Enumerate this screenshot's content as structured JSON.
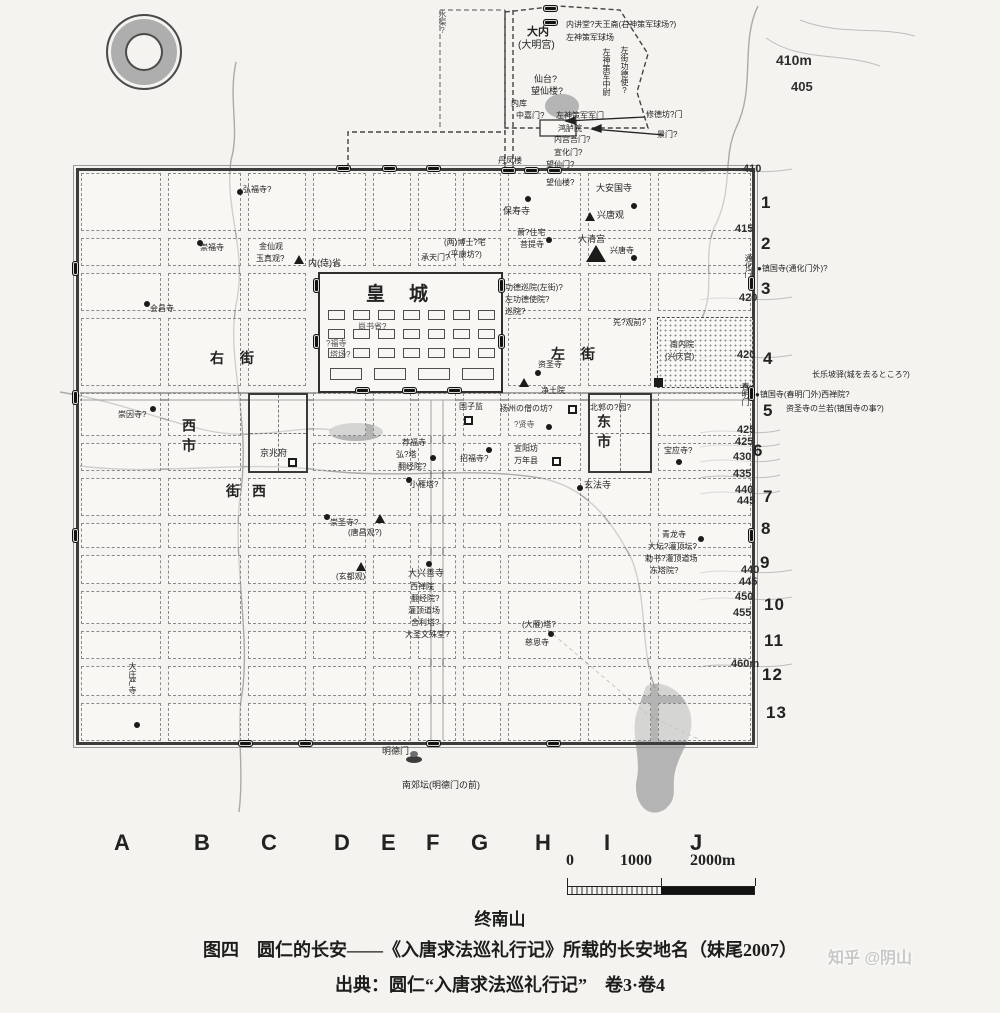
{
  "figure": {
    "mountain_label": "终南山",
    "caption_line1": "图四　圆仁的长安——《入唐求法巡礼行记》所载的长安地名（妹尾2007）",
    "caption_line2": "出典：圆仁“入唐求法巡礼行记”　卷3·卷4",
    "watermark": "知乎 @阴山"
  },
  "scalebar": {
    "t0": "0",
    "t1": "1000",
    "t2": "2000m"
  },
  "grid_letters": [
    {
      "t": "A",
      "x": 114
    },
    {
      "t": "B",
      "x": 194
    },
    {
      "t": "C",
      "x": 261
    },
    {
      "t": "D",
      "x": 334
    },
    {
      "t": "E",
      "x": 381
    },
    {
      "t": "F",
      "x": 426
    },
    {
      "t": "G",
      "x": 471
    },
    {
      "t": "H",
      "x": 535
    },
    {
      "t": "I",
      "x": 604
    },
    {
      "t": "J",
      "x": 690
    }
  ],
  "row_numbers": [
    {
      "t": "1",
      "x": 761,
      "y": 193
    },
    {
      "t": "2",
      "x": 761,
      "y": 234
    },
    {
      "t": "3",
      "x": 761,
      "y": 279
    },
    {
      "t": "4",
      "x": 763,
      "y": 349
    },
    {
      "t": "5",
      "x": 763,
      "y": 401
    },
    {
      "t": "6",
      "x": 753,
      "y": 441
    },
    {
      "t": "7",
      "x": 763,
      "y": 487
    },
    {
      "t": "8",
      "x": 761,
      "y": 519
    },
    {
      "t": "9",
      "x": 760,
      "y": 553
    },
    {
      "t": "10",
      "x": 764,
      "y": 595
    },
    {
      "t": "11",
      "x": 764,
      "y": 631
    },
    {
      "t": "12",
      "x": 762,
      "y": 665
    },
    {
      "t": "13",
      "x": 766,
      "y": 703
    }
  ],
  "elevations": [
    {
      "t": "410m",
      "x": 776,
      "y": 52,
      "fs": 14
    },
    {
      "t": "405",
      "x": 791,
      "y": 79,
      "fs": 13
    },
    {
      "t": "410",
      "x": 743,
      "y": 163
    },
    {
      "t": "415",
      "x": 735,
      "y": 223
    },
    {
      "t": "420",
      "x": 739,
      "y": 292
    },
    {
      "t": "420",
      "x": 737,
      "y": 349
    },
    {
      "t": "425",
      "x": 737,
      "y": 424
    },
    {
      "t": "425",
      "x": 735,
      "y": 436
    },
    {
      "t": "430",
      "x": 733,
      "y": 451
    },
    {
      "t": "435",
      "x": 733,
      "y": 468
    },
    {
      "t": "440",
      "x": 735,
      "y": 484
    },
    {
      "t": "445",
      "x": 737,
      "y": 495
    },
    {
      "t": "440",
      "x": 741,
      "y": 564
    },
    {
      "t": "445",
      "x": 739,
      "y": 576
    },
    {
      "t": "450",
      "x": 735,
      "y": 591
    },
    {
      "t": "455",
      "x": 733,
      "y": 607
    },
    {
      "t": "460m",
      "x": 731,
      "y": 658
    }
  ],
  "labels": [
    {
      "t": "大内",
      "x": 527,
      "y": 26,
      "fs": 11,
      "b": 1
    },
    {
      "t": "(大明宫)",
      "x": 518,
      "y": 40,
      "fs": 10
    },
    {
      "t": "内讲堂?天王斋(右神策军球场?)",
      "x": 566,
      "y": 20,
      "fs": 8
    },
    {
      "t": "左神策军球场",
      "x": 566,
      "y": 33,
      "fs": 8
    },
    {
      "t": "仙台?",
      "x": 534,
      "y": 74,
      "fs": 9
    },
    {
      "t": "望仙楼?",
      "x": 531,
      "y": 86,
      "fs": 9
    },
    {
      "t": "左神策军中尉",
      "x": 602,
      "y": 48,
      "fs": 8,
      "v": 1
    },
    {
      "t": "左街功德使?",
      "x": 620,
      "y": 46,
      "fs": 8,
      "v": 1
    },
    {
      "t": "水渠?",
      "x": 438,
      "y": 10,
      "fs": 8,
      "v": 1,
      "c": "#555"
    },
    {
      "t": "内库",
      "x": 511,
      "y": 99,
      "fs": 8
    },
    {
      "t": "中嘉门?",
      "x": 516,
      "y": 111,
      "fs": 8
    },
    {
      "t": "左神策军军门",
      "x": 556,
      "y": 111,
      "fs": 8
    },
    {
      "t": "鸿胪院",
      "x": 558,
      "y": 124,
      "fs": 8
    },
    {
      "t": "内宫吾门?",
      "x": 554,
      "y": 135,
      "fs": 8
    },
    {
      "t": "宣化门?",
      "x": 554,
      "y": 148,
      "fs": 8
    },
    {
      "t": "丹凤楼",
      "x": 498,
      "y": 156,
      "fs": 8
    },
    {
      "t": "望仙门?",
      "x": 546,
      "y": 160,
      "fs": 8
    },
    {
      "t": "修德坊?门",
      "x": 646,
      "y": 110,
      "fs": 8
    },
    {
      "t": "景门?",
      "x": 657,
      "y": 130,
      "fs": 8
    },
    {
      "t": "弘福寺?",
      "x": 243,
      "y": 185,
      "fs": 8
    },
    {
      "t": "望仙楼?",
      "x": 546,
      "y": 178,
      "fs": 8
    },
    {
      "t": "大安国寺",
      "x": 596,
      "y": 183,
      "fs": 9
    },
    {
      "t": "保寿寺",
      "x": 503,
      "y": 206,
      "fs": 9
    },
    {
      "t": "兴唐观",
      "x": 597,
      "y": 210,
      "fs": 9
    },
    {
      "t": "崇福寺",
      "x": 200,
      "y": 243,
      "fs": 8
    },
    {
      "t": "金仙观",
      "x": 259,
      "y": 242,
      "fs": 8
    },
    {
      "t": "玉真观?",
      "x": 256,
      "y": 254,
      "fs": 8
    },
    {
      "t": "(两)博士?宅",
      "x": 444,
      "y": 238,
      "fs": 8
    },
    {
      "t": "(平康坊?)",
      "x": 448,
      "y": 250,
      "fs": 8
    },
    {
      "t": "萧?住宅",
      "x": 517,
      "y": 228,
      "fs": 8
    },
    {
      "t": "菩提寺",
      "x": 520,
      "y": 240,
      "fs": 8
    },
    {
      "t": "大清宫",
      "x": 578,
      "y": 234,
      "fs": 9
    },
    {
      "t": "兴唐寺",
      "x": 610,
      "y": 246,
      "fs": 8
    },
    {
      "t": "内(侍)省",
      "x": 308,
      "y": 258,
      "fs": 9
    },
    {
      "t": "承天门?",
      "x": 421,
      "y": 253,
      "fs": 8
    },
    {
      "t": "会昌寺",
      "x": 150,
      "y": 304,
      "fs": 8
    },
    {
      "t": "皇城",
      "x": 366,
      "y": 284,
      "fs": 19,
      "b": 1,
      "sp": 24
    },
    {
      "t": "功德巡院(左街)?",
      "x": 505,
      "y": 283,
      "fs": 8
    },
    {
      "t": "左功德使院?",
      "x": 505,
      "y": 295,
      "fs": 8
    },
    {
      "t": "巡院?",
      "x": 505,
      "y": 307,
      "fs": 8
    },
    {
      "t": "先?观前?",
      "x": 613,
      "y": 318,
      "fs": 8
    },
    {
      "t": "尚书省?",
      "x": 358,
      "y": 322,
      "fs": 8,
      "c": "#444"
    },
    {
      "t": "?福寺",
      "x": 326,
      "y": 339,
      "fs": 8,
      "c": "#555"
    },
    {
      "t": "塔场?",
      "x": 330,
      "y": 350,
      "fs": 8,
      "c": "#555"
    },
    {
      "t": "右街",
      "x": 210,
      "y": 350,
      "fs": 14,
      "b": 1,
      "sp": 16
    },
    {
      "t": "左街",
      "x": 551,
      "y": 346,
      "fs": 14,
      "b": 1,
      "sp": 16
    },
    {
      "t": "资圣寺",
      "x": 538,
      "y": 360,
      "fs": 8
    },
    {
      "t": "净土院",
      "x": 541,
      "y": 386,
      "fs": 8
    },
    {
      "t": "南内院",
      "x": 670,
      "y": 340,
      "fs": 8
    },
    {
      "t": "(兴庆宫)",
      "x": 665,
      "y": 352,
      "fs": 8
    },
    {
      "t": "通化门",
      "x": 744,
      "y": 254,
      "fs": 8,
      "v": 1
    },
    {
      "t": "●镇国寺(通化门外)?",
      "x": 757,
      "y": 264,
      "fs": 8
    },
    {
      "t": "春明门",
      "x": 741,
      "y": 382,
      "fs": 8,
      "v": 1
    },
    {
      "t": "长乐坡驿(城を去るところ?)",
      "x": 812,
      "y": 370,
      "fs": 8
    },
    {
      "t": "●镇国寺(春明门外)西禅院?",
      "x": 755,
      "y": 390,
      "fs": 8
    },
    {
      "t": "资圣寺の兰若(镇国寺の事?)",
      "x": 786,
      "y": 404,
      "fs": 8
    },
    {
      "t": "崇因寺?",
      "x": 118,
      "y": 410,
      "fs": 8
    },
    {
      "t": "国子监",
      "x": 459,
      "y": 402,
      "fs": 8
    },
    {
      "t": "扬州の僧の坊?",
      "x": 500,
      "y": 404,
      "fs": 8
    },
    {
      "t": "北郭の?园?",
      "x": 590,
      "y": 403,
      "fs": 8
    },
    {
      "t": "?贤寺",
      "x": 514,
      "y": 420,
      "fs": 8,
      "c": "#555"
    },
    {
      "t": "西市",
      "x": 182,
      "y": 418,
      "fs": 14,
      "b": 1,
      "v": 1,
      "sp": 6
    },
    {
      "t": "东市",
      "x": 597,
      "y": 414,
      "fs": 14,
      "b": 1,
      "v": 1,
      "sp": 6
    },
    {
      "t": "京兆府",
      "x": 260,
      "y": 448,
      "fs": 9
    },
    {
      "t": "宝应寺?",
      "x": 664,
      "y": 446,
      "fs": 8
    },
    {
      "t": "招福寺?",
      "x": 460,
      "y": 454,
      "fs": 8
    },
    {
      "t": "宣阳坊",
      "x": 514,
      "y": 444,
      "fs": 8
    },
    {
      "t": "万年县",
      "x": 514,
      "y": 456,
      "fs": 8
    },
    {
      "t": "荐福寺",
      "x": 402,
      "y": 438,
      "fs": 8
    },
    {
      "t": "弘?塔",
      "x": 396,
      "y": 450,
      "fs": 8
    },
    {
      "t": "翻经院?",
      "x": 398,
      "y": 462,
      "fs": 8
    },
    {
      "t": "小雁塔?",
      "x": 410,
      "y": 480,
      "fs": 8
    },
    {
      "t": "街西",
      "x": 226,
      "y": 483,
      "fs": 14,
      "b": 1,
      "sp": 12
    },
    {
      "t": "玄法寺",
      "x": 584,
      "y": 480,
      "fs": 9
    },
    {
      "t": "崇圣寺?",
      "x": 330,
      "y": 518,
      "fs": 8
    },
    {
      "t": "(唐昌观?)",
      "x": 348,
      "y": 528,
      "fs": 8
    },
    {
      "t": "青龙寺",
      "x": 662,
      "y": 530,
      "fs": 8
    },
    {
      "t": "大坛?灌顶坛?",
      "x": 648,
      "y": 542,
      "fs": 8
    },
    {
      "t": "勅书?灌顶道场",
      "x": 645,
      "y": 554,
      "fs": 8
    },
    {
      "t": "东塔院?",
      "x": 650,
      "y": 566,
      "fs": 8
    },
    {
      "t": "(玄都观)",
      "x": 336,
      "y": 572,
      "fs": 8
    },
    {
      "t": "大兴善寺",
      "x": 408,
      "y": 568,
      "fs": 9
    },
    {
      "t": "西禅院",
      "x": 410,
      "y": 582,
      "fs": 8
    },
    {
      "t": "翻经院?",
      "x": 411,
      "y": 594,
      "fs": 8
    },
    {
      "t": "灌顶道场",
      "x": 408,
      "y": 606,
      "fs": 8
    },
    {
      "t": "舍利塔?",
      "x": 411,
      "y": 618,
      "fs": 8
    },
    {
      "t": "大圣文殊堂?",
      "x": 405,
      "y": 630,
      "fs": 8
    },
    {
      "t": "(大雁)塔?",
      "x": 522,
      "y": 620,
      "fs": 8
    },
    {
      "t": "慈恩寺",
      "x": 525,
      "y": 638,
      "fs": 8
    },
    {
      "t": "大庄严寺",
      "x": 128,
      "y": 662,
      "fs": 8,
      "v": 1
    },
    {
      "t": "明德门",
      "x": 382,
      "y": 746,
      "fs": 9
    },
    {
      "t": "南郊坛(明德门の前)",
      "x": 402,
      "y": 780,
      "fs": 9
    }
  ],
  "markers": [
    {
      "k": "c",
      "x": 237,
      "y": 189
    },
    {
      "k": "c",
      "x": 525,
      "y": 196
    },
    {
      "k": "c",
      "x": 631,
      "y": 203
    },
    {
      "k": "c",
      "x": 197,
      "y": 240
    },
    {
      "k": "c",
      "x": 144,
      "y": 301
    },
    {
      "k": "c",
      "x": 546,
      "y": 237
    },
    {
      "k": "c",
      "x": 631,
      "y": 255
    },
    {
      "k": "c",
      "x": 535,
      "y": 370
    },
    {
      "k": "c",
      "x": 150,
      "y": 406
    },
    {
      "k": "c",
      "x": 486,
      "y": 447
    },
    {
      "k": "c",
      "x": 546,
      "y": 424
    },
    {
      "k": "c",
      "x": 577,
      "y": 485
    },
    {
      "k": "c",
      "x": 430,
      "y": 455
    },
    {
      "k": "c",
      "x": 406,
      "y": 477
    },
    {
      "k": "c",
      "x": 324,
      "y": 514
    },
    {
      "k": "c",
      "x": 426,
      "y": 561
    },
    {
      "k": "c",
      "x": 548,
      "y": 631
    },
    {
      "k": "c",
      "x": 698,
      "y": 536
    },
    {
      "k": "c",
      "x": 676,
      "y": 459
    },
    {
      "k": "c",
      "x": 134,
      "y": 722
    },
    {
      "k": "t",
      "x": 294,
      "y": 255
    },
    {
      "k": "t",
      "x": 585,
      "y": 212
    },
    {
      "k": "t",
      "x": 519,
      "y": 378
    },
    {
      "k": "t",
      "x": 375,
      "y": 514
    },
    {
      "k": "t",
      "x": 356,
      "y": 562
    },
    {
      "k": "T",
      "x": 586,
      "y": 245
    },
    {
      "k": "s",
      "x": 654,
      "y": 378
    },
    {
      "k": "o",
      "x": 464,
      "y": 416
    },
    {
      "k": "o",
      "x": 288,
      "y": 458
    },
    {
      "k": "o",
      "x": 552,
      "y": 457
    },
    {
      "k": "o",
      "x": 568,
      "y": 405
    },
    {
      "k": "altar",
      "x": 406,
      "y": 756
    },
    {
      "k": "gh",
      "x": 336,
      "y": 165
    },
    {
      "k": "gh",
      "x": 382,
      "y": 165
    },
    {
      "k": "gh",
      "x": 426,
      "y": 165
    },
    {
      "k": "gh",
      "x": 501,
      "y": 167
    },
    {
      "k": "gh",
      "x": 524,
      "y": 167
    },
    {
      "k": "gh",
      "x": 547,
      "y": 167
    },
    {
      "k": "gh",
      "x": 238,
      "y": 740
    },
    {
      "k": "gh",
      "x": 298,
      "y": 740
    },
    {
      "k": "gh",
      "x": 426,
      "y": 740
    },
    {
      "k": "gh",
      "x": 546,
      "y": 740
    },
    {
      "k": "gh",
      "x": 355,
      "y": 387
    },
    {
      "k": "gh",
      "x": 402,
      "y": 387
    },
    {
      "k": "gh",
      "x": 447,
      "y": 387
    },
    {
      "k": "gh",
      "x": 543,
      "y": 5
    },
    {
      "k": "gh",
      "x": 543,
      "y": 19
    },
    {
      "k": "gv",
      "x": 72,
      "y": 261
    },
    {
      "k": "gv",
      "x": 72,
      "y": 390
    },
    {
      "k": "gv",
      "x": 72,
      "y": 528
    },
    {
      "k": "gv",
      "x": 748,
      "y": 276
    },
    {
      "k": "gv",
      "x": 748,
      "y": 386
    },
    {
      "k": "gv",
      "x": 748,
      "y": 528
    },
    {
      "k": "gv",
      "x": 313,
      "y": 278
    },
    {
      "k": "gv",
      "x": 313,
      "y": 334
    },
    {
      "k": "gv",
      "x": 498,
      "y": 278
    },
    {
      "k": "gv",
      "x": 498,
      "y": 334
    }
  ]
}
